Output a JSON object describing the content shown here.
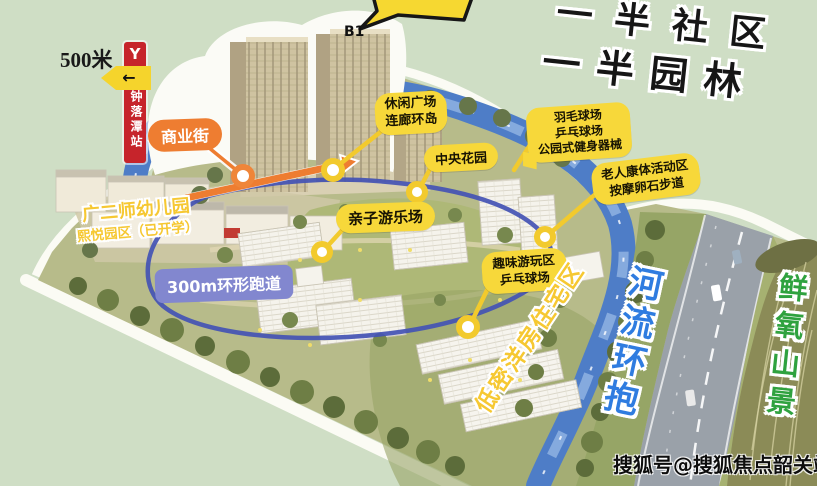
{
  "colors": {
    "background_green": "#cfdec5",
    "label_yellow": "#f7d83a",
    "label_orange": "#ee7d31",
    "track_label_purple": "#8287cf",
    "track_line_blue": "#4353b4",
    "river_blue": "#4e7dc7",
    "river_text_blue": "#2f7ce0",
    "mountain_text_green": "#2fa23f",
    "station_red": "#c6242b",
    "marker_ring_yellow": "#f2ca2d",
    "marker_ring_orange": "#ef8539",
    "painted_text_yellow": "#f6c832"
  },
  "slogan": {
    "line1": "一半社区",
    "line2": "一半园林"
  },
  "station": {
    "distance": "500米",
    "name": "钟落潭站",
    "logo_glyph": "Y",
    "arrow_glyph": "←"
  },
  "tower_label": "B1",
  "labels": {
    "commercial_street": "商业街",
    "leisure_plaza": {
      "line1": "休闲广场",
      "line2": "连廊环岛"
    },
    "central_garden": "中央花园",
    "sports_park": {
      "line1": "羽毛球场",
      "line2": "乒乓球场",
      "line3": "公园式健身器械"
    },
    "elderly_zone": {
      "line1": "老人康体活动区",
      "line2": "按摩卵石步道"
    },
    "family_playground": "亲子游乐场",
    "kindergarten": {
      "line1": "广二师幼儿园",
      "line2": "熙悦园区（已开学）"
    },
    "running_track": "300m环形跑道",
    "fun_play_area": {
      "line1": "趣味游玩区",
      "line2": "乒乓球场"
    },
    "lowrise_residential": "低密洋房住宅区",
    "river_embrace": "河流环抱",
    "fresh_oxygen_mountain": "鲜氧山景"
  },
  "watermark": "搜狐号@搜狐焦点韶关站"
}
